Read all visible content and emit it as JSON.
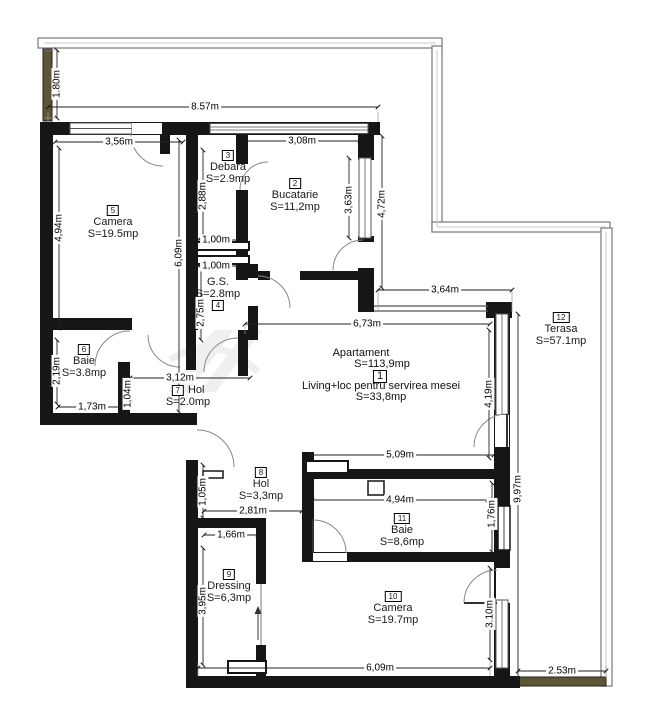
{
  "plan": {
    "apartment": {
      "title": "Apartament",
      "total_area": "S=113,9mp",
      "living": {
        "number": "1",
        "name": "Living+loc pentru servirea mesei",
        "area": "S=33,8mp"
      }
    },
    "rooms": {
      "bucatarie": {
        "number": "2",
        "name": "Bucatarie",
        "area": "S=11,2mp"
      },
      "debara": {
        "number": "3",
        "name": "Debara",
        "area": "S=2.9mp"
      },
      "gs": {
        "number": "4",
        "name": "G.S.",
        "area": "S=2.8mp"
      },
      "camera5": {
        "number": "5",
        "name": "Camera",
        "area": "S=19.5mp"
      },
      "baie6": {
        "number": "6",
        "name": "Baie",
        "area": "S=3.8mp"
      },
      "hol7": {
        "number": "7",
        "name": "Hol",
        "area": "S=2.0mp"
      },
      "hol8": {
        "number": "8",
        "name": "Hol",
        "area": "S=3,3mp"
      },
      "dressing": {
        "number": "9",
        "name": "Dressing",
        "area": "S=6,3mp"
      },
      "camera10": {
        "number": "10",
        "name": "Camera",
        "area": "S=19.7mp"
      },
      "baie11": {
        "number": "11",
        "name": "Baie",
        "area": "S=8,6mp"
      },
      "terasa": {
        "number": "12",
        "name": "Terasa",
        "area": "S=57.1mp"
      }
    },
    "dimensions": {
      "parapet_height": "1.80m",
      "top_width": "8.57m",
      "camera5_width": "3,56m",
      "bucatarie_width": "3,08m",
      "debara_height": "2,88m",
      "bucatarie_window_height": "3,63m",
      "bucatarie_depth": "4,72m",
      "camera5_height": "4,94m",
      "corridor_height": "6,09m",
      "gs_width_upper": "1,00m",
      "gs_width_lower": "1,00m",
      "gs_height": "2,75m",
      "terasa_top_width": "3,64m",
      "living_width": "6,73m",
      "baie6_height": "2,19m",
      "baie6_width": "1,73m",
      "hol7_width": "3,12m",
      "hol7_height": "1,04m",
      "living_glazing_height": "4,19m",
      "terasa_side_height": "9,97m",
      "baie11_top_width": "5,09m",
      "baie11_width": "4,94m",
      "baie11_height": "1,76m",
      "hol8_height": "1,05m",
      "hol8_width": "2,81m",
      "dressing_door_width": "1,66m",
      "dressing_height": "3,95m",
      "camera10_door_height": "3.10m",
      "camera10_width": "6,09m",
      "terasa_bottom_width": "2.53m"
    },
    "colors": {
      "wall": "#161616",
      "parapet_line": "#8a8a8a",
      "wood": "#5e5536",
      "dim_line": "#222222"
    }
  }
}
